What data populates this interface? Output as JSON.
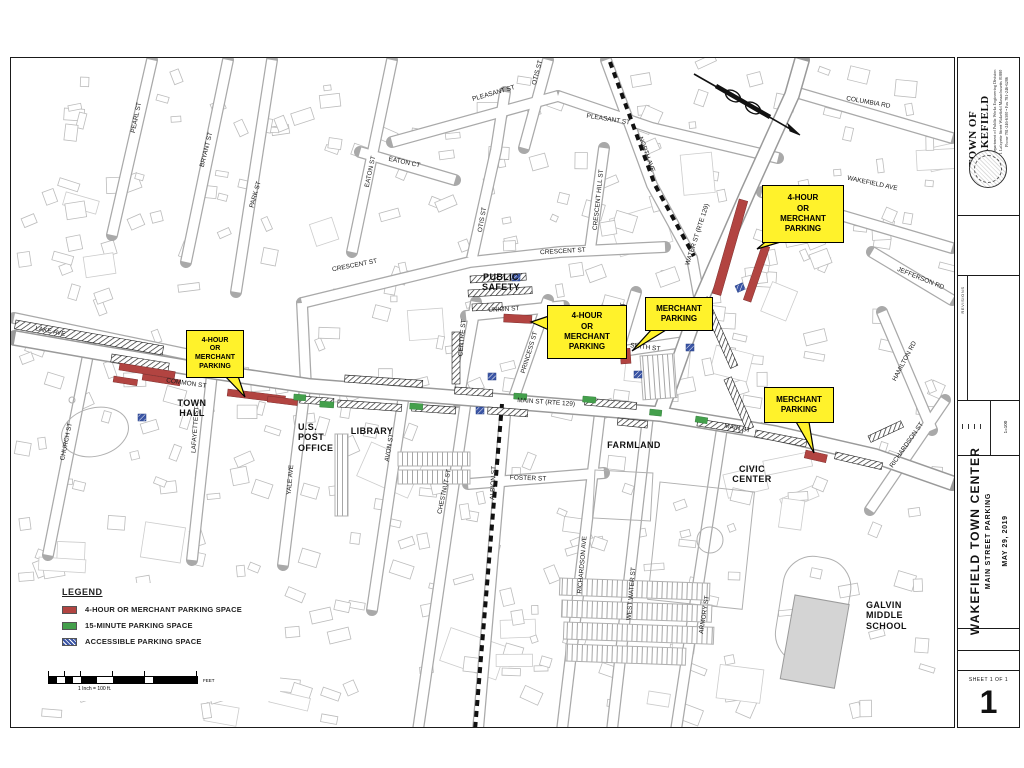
{
  "map": {
    "street_labels": [
      {
        "label": "PEARL ST"
      },
      {
        "label": "BRYANT ST"
      },
      {
        "label": "PARK ST"
      },
      {
        "label": "EATON ST"
      },
      {
        "label": "EATON CT"
      },
      {
        "label": "PLEASANT ST"
      },
      {
        "label": "PLEASANT ST"
      },
      {
        "label": "OTIS ST"
      },
      {
        "label": "OTIS ST"
      },
      {
        "label": "CRESCENT HILL ST"
      },
      {
        "label": "CRESCENT ST"
      },
      {
        "label": "CRESCENT ST"
      },
      {
        "label": "COLUMBIA RD"
      },
      {
        "label": "WAKEFIELD AVE"
      },
      {
        "label": "JEFFERSON RD"
      },
      {
        "label": "NORTH AVE"
      },
      {
        "label": "WATER ST (RTE 129)"
      },
      {
        "label": "CHURCH ST"
      },
      {
        "label": "LAKE AVE"
      },
      {
        "label": "COMMON ST"
      },
      {
        "label": "LAFAYETTE ST"
      },
      {
        "label": "YALE AVE"
      },
      {
        "label": "AVON ST"
      },
      {
        "label": "CHESTNUT ST"
      },
      {
        "label": "ALBION ST"
      },
      {
        "label": "FOSTER ST"
      },
      {
        "label": "RICHARDSON AVE"
      },
      {
        "label": "WEST WATER ST"
      },
      {
        "label": "ARMORY ST"
      },
      {
        "label": "CENTRE ST"
      },
      {
        "label": "PRINCESS ST"
      },
      {
        "label": "UNION ST"
      },
      {
        "label": "SMITH ST"
      },
      {
        "label": "LINCOLN ST"
      },
      {
        "label": "MAIN ST (RTE 129)"
      },
      {
        "label": "MAIN ST"
      },
      {
        "label": "RICHARDSON ST"
      },
      {
        "label": "HAMILTON RD"
      }
    ],
    "place_labels": [
      {
        "label": "PUBLIC\nSAFETY"
      },
      {
        "label": "TOWN\nHALL"
      },
      {
        "label": "U.S.\nPOST\nOFFICE"
      },
      {
        "label": "LIBRARY"
      },
      {
        "label": "FARMLAND"
      },
      {
        "label": "CIVIC\nCENTER"
      },
      {
        "label": "GALVIN\nMIDDLE\nSCHOOL"
      }
    ],
    "callouts": [
      {
        "label": "4-HOUR\nOR\nMERCHANT\nPARKING"
      },
      {
        "label": "4-HOUR\nOR\nMERCHANT\nPARKING"
      },
      {
        "label": "MERCHANT\nPARKING"
      },
      {
        "label": "4-HOUR\nOR\nMERCHANT\nPARKING"
      },
      {
        "label": "MERCHANT\nPARKING"
      }
    ]
  },
  "legend": {
    "title": "LEGEND",
    "items": [
      {
        "label": "4-HOUR OR MERCHANT PARKING SPACE",
        "swatch": "red"
      },
      {
        "label": "15-MINUTE PARKING SPACE",
        "swatch": "green"
      },
      {
        "label": "ACCESSIBLE PARKING SPACE",
        "swatch": "blue-hatch"
      }
    ],
    "scale_caption": "1 Inch = 100 ft.",
    "scale_unit": "FEET"
  },
  "title_block": {
    "agency": "TOWN OF WAKEFIELD",
    "dept_line1": "Department of Public Works Engineering Division",
    "dept_line2": "1 Lafayette Street Wakefield Massachusetts 01880",
    "dept_line3": "Phone 781-246-6300  •  Fax 781-246-6286",
    "revisions_label": "REVISIONS",
    "scale_label": "1=100",
    "project_title": "WAKEFIELD TOWN CENTER",
    "project_subtitle": "MAIN STREET PARKING",
    "date": "MAY 29, 2019",
    "sheet_label": "SHEET 1 OF 1",
    "sheet_number": "1"
  },
  "colors": {
    "four_hour_merchant": "#B24441",
    "fifteen_minute": "#44A04C",
    "accessible": "#3B55A5",
    "callout_yellow": "#FFF22B"
  }
}
